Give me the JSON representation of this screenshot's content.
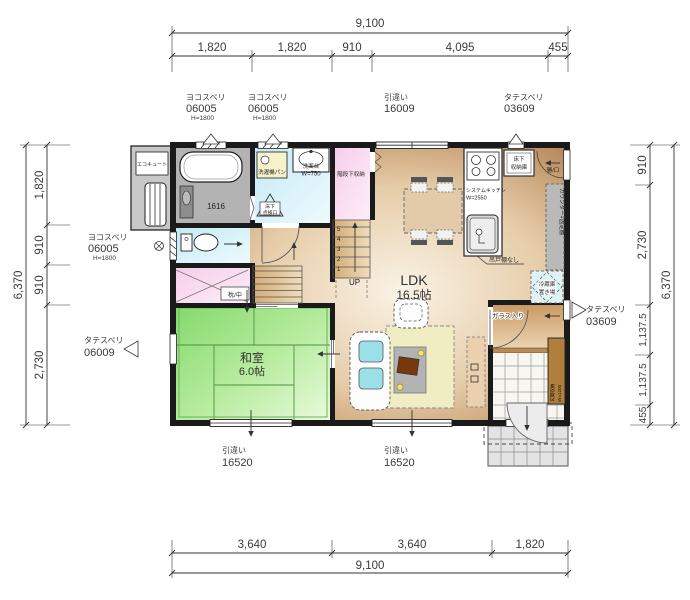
{
  "dimensions": {
    "top": {
      "total": "9,100",
      "segments": [
        "1,820",
        "1,820",
        "910",
        "4,095",
        "455"
      ]
    },
    "bottom": {
      "total": "9,100",
      "segments": [
        "3,640",
        "3,640",
        "1,820"
      ]
    },
    "left": {
      "total": "6,370",
      "segments": [
        "1,820",
        "910",
        "910",
        "2,730"
      ]
    },
    "right": {
      "total": "6,370",
      "segments": [
        "910",
        "2,730",
        "1,137.5",
        "1,137.5",
        "455"
      ]
    }
  },
  "openings": {
    "top_win1": {
      "type": "ヨコスベリ",
      "code": "06005",
      "h": "H=1800"
    },
    "top_win2": {
      "type": "ヨコスベリ",
      "code": "06005",
      "h": "H=1800"
    },
    "top_win3": {
      "type": "引違い",
      "code": "16009"
    },
    "top_win4": {
      "type": "タテスベリ",
      "code": "03609"
    },
    "left_win1": {
      "type": "ヨコスベリ",
      "code": "06005",
      "h": "H=1800"
    },
    "left_win2": {
      "type": "タテスベリ",
      "code": "06009"
    },
    "right_win1": {
      "type": "タテスベリ",
      "code": "03609"
    },
    "bottom_win1": {
      "type": "引違い",
      "code": "16520"
    },
    "bottom_win2": {
      "type": "引違い",
      "code": "16520"
    },
    "back_door_label": "勝/口"
  },
  "rooms": {
    "ldk": {
      "name": "LDK",
      "area": "16.5帖"
    },
    "washitsu": {
      "name": "和室",
      "area": "6.0帖"
    }
  },
  "fixtures": {
    "ecocute": "エコキュート",
    "bath_size": "1616",
    "washer_pan": "洗濯機パン",
    "inspection_l1": "床下",
    "inspection_l2": "点検口",
    "vanity": "洗面台",
    "vanity_w": "W=750",
    "stair_storage": "階段下収納",
    "up": "UP",
    "closet_shelf": "枕/中",
    "floor_storage_l1": "床下",
    "floor_storage_l2": "収納庫",
    "kitchen": "システムキッチン",
    "kitchen_w": "W=2550",
    "no_hanging_cupboard": "吊戸棚なし",
    "counter_shelf": "カウンター+固定棚",
    "fridge_l1": "冷蔵庫",
    "fridge_l2": "置き場",
    "glass_door": "ガラス入り",
    "entrance_storage": "玄関収納",
    "entrance_storage_w": "W=1200"
  },
  "stairs": {
    "numbers": [
      "1",
      "2",
      "3",
      "4",
      "5"
    ]
  },
  "colors": {
    "tatami_green": "#8ddb77",
    "wood_brown": "#c0895a",
    "water_blue": "#cfeef7",
    "closet_pink": "#f6d3ec",
    "rug_yellow": "#f1edc3",
    "counter_gray": "#b9b9b9",
    "cushion_cyan": "#9bdfe8",
    "wall_black": "#1a1a1a"
  }
}
